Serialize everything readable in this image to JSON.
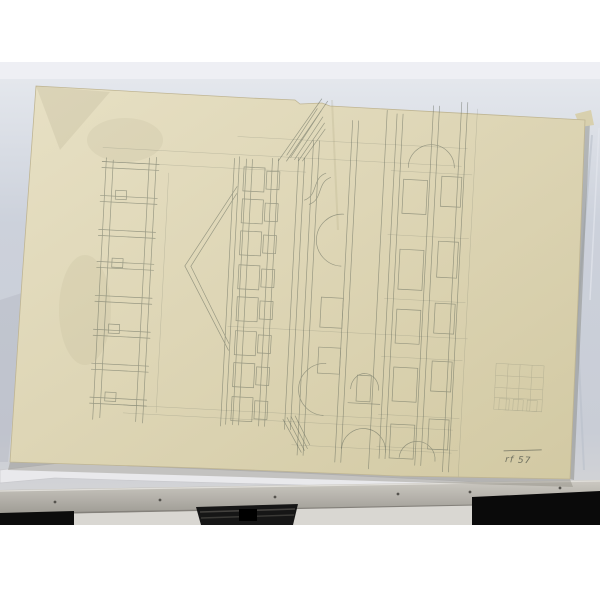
{
  "scene": {
    "type": "photograph",
    "subject": "pencil architectural elevation drawing on yellowed paper propped on a chalk rail against a pale wall",
    "white_border_color": "#ffffff"
  },
  "wall": {
    "color_top_band": "#eceef2",
    "color_main": "#cbd0da",
    "color_lower": "#d8d7d6"
  },
  "ledge": {
    "color": "#b9b6af",
    "screw_color": "#55534e",
    "screw_count": 6
  },
  "shadows": {
    "left_block_color": "#0c0c0c",
    "right_block_color": "#0a0a0a",
    "stand_color": "#161616"
  },
  "paper": {
    "color": "#ded6b6",
    "edge_color": "#cfc6a2",
    "note": "rf 57",
    "note_style": "faint underlined pencil handwriting, lower right corner"
  },
  "drawing": {
    "medium": "graphite pencil",
    "pencil_color": "#5f6659",
    "orientation": "elevation drawn rotated 90 degrees on the sheet (pediment apex points left)",
    "elements": [
      "narrow side-elevation strip with molding bands (left)",
      "triangular pediment with double cornice lines",
      "two-tier colonnade of stacked column drums",
      "central bays with arches, consoles and hatched roof section",
      "right facade with two rows of rectangular windows and arched openings",
      "arched doorway niche",
      "small gridded detail sketch (far right)",
      "long construction lines across the sheet"
    ]
  }
}
